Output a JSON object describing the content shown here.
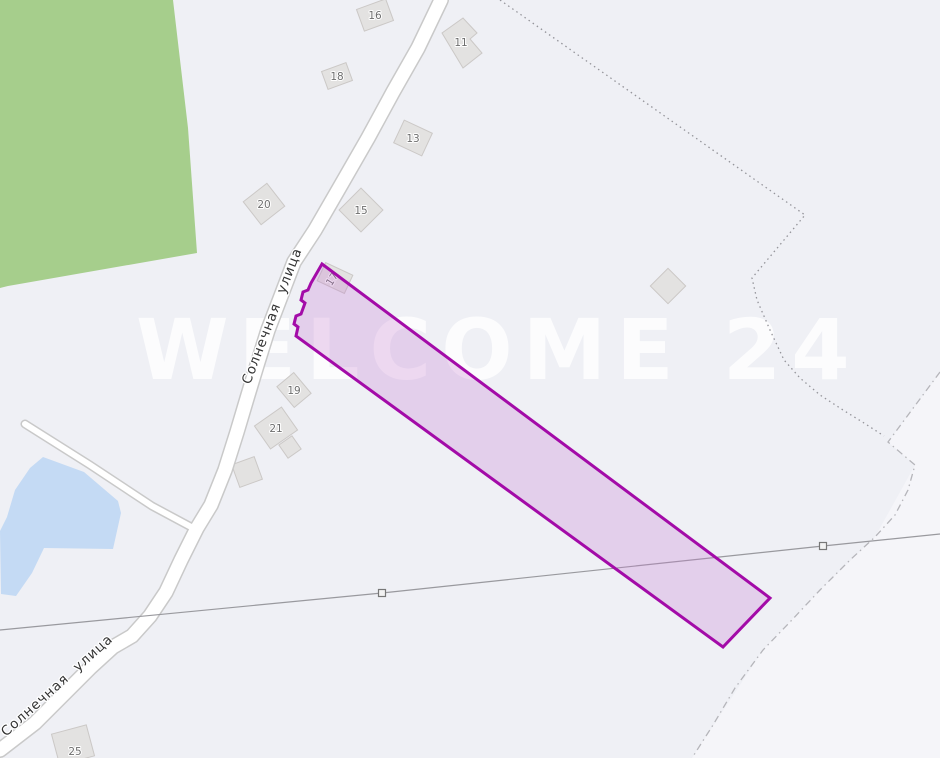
{
  "map": {
    "colors": {
      "background": "#eff0f5",
      "terrain_shade": "#f5f5f9",
      "green_area": "#a6ce8c",
      "pond": "#c4daf4",
      "road_fill": "#ffffff",
      "road_casing": "#c9c9c9",
      "building_fill": "#e3e2e1",
      "building_stroke": "#cbc8c6",
      "power_line": "#99999e",
      "marker_fill": "#f2f2f2",
      "marker_stroke": "#777777",
      "dotted_boundary": "#94949a",
      "dashdot_boundary": "#b5b5ba",
      "parcel_stroke": "#a30ba8",
      "parcel_fill": "rgba(197,122,209,0.28)"
    },
    "terrain_shade": {
      "points": "940,373 888,442 915,465 875,537 820,590 763,650 692,758 940,758"
    },
    "green_area": {
      "points": "0,0 173,0 188,128 197,253 8,286 0,288"
    },
    "pond": {
      "points": "43,457 84,472 118,501 121,513 113,549 44,548 32,573 16,596 1,594 0,531 7,517 15,490 30,468"
    },
    "watermark": {
      "text": "WELCOME 24",
      "x": 136,
      "y": 379
    },
    "buildings": [
      {
        "label": "16",
        "cx": 375,
        "cy": 15,
        "w": 31,
        "h": 23,
        "angle": -20
      },
      {
        "label": "11",
        "points": "442,33 463,18 477,33 470,39 482,53 463,68",
        "lx": 461,
        "ly": 42
      },
      {
        "label": "18",
        "cx": 337,
        "cy": 76,
        "w": 26,
        "h": 19,
        "angle": -20
      },
      {
        "label": "13",
        "cx": 413,
        "cy": 138,
        "w": 31,
        "h": 25,
        "angle": 25
      },
      {
        "label": "20",
        "cx": 264,
        "cy": 204,
        "w": 30,
        "h": 29,
        "angle": -38
      },
      {
        "label": "15",
        "cx": 361,
        "cy": 210,
        "w": 31,
        "h": 31,
        "angle": -45
      },
      {
        "label": "19",
        "cx": 294,
        "cy": 390,
        "w": 22,
        "h": 27,
        "angle": -40
      },
      {
        "label": "21",
        "cx": 276,
        "cy": 428,
        "w": 33,
        "h": 28,
        "angle": -35
      },
      {
        "label": "",
        "cx": 290,
        "cy": 447,
        "w": 16,
        "h": 16,
        "angle": -35
      },
      {
        "label": "",
        "cx": 247,
        "cy": 472,
        "w": 24,
        "h": 24,
        "angle": -20
      },
      {
        "label": "25",
        "cx": 73,
        "cy": 745,
        "w": 36,
        "h": 32,
        "angle": -15,
        "lx": 75,
        "ly": 751
      },
      {
        "label": "",
        "cx": 668,
        "cy": 286,
        "w": 25,
        "h": 25,
        "angle": 45
      }
    ],
    "roads": {
      "main": {
        "points": "441,0 418,48 393,92 368,138 341,185 315,230 294,262 281,296 268,330 258,362 248,395 237,432 225,470 211,505 197,528 181,560 166,592 150,616 132,636 113,647 90,668 63,695 35,723 0,750",
        "width": 13,
        "casing": 16
      },
      "side": {
        "points": "25,424 90,465 152,506 193,528",
        "width": 6,
        "casing": 9
      }
    },
    "street_labels": [
      {
        "text": "Солнечная улица",
        "x": 250,
        "y": 385,
        "angle": -69
      },
      {
        "text": "Солнечная улица",
        "x": 6,
        "y": 737,
        "angle": -42
      }
    ],
    "power_line": {
      "points": "0,630 382,593 823,546 940,534",
      "markers": [
        {
          "x": 382,
          "y": 593
        },
        {
          "x": 823,
          "y": 546
        }
      ]
    },
    "dotted_boundary": {
      "points": "500,0 805,215 752,278 757,300 770,330 784,360 800,378 820,395 843,410 864,423 884,436"
    },
    "dashdot_boundary": {
      "points": "940,372 888,442 915,465 908,490 895,515 875,537 850,560 820,590 790,622 763,650 735,688 713,725 692,758"
    },
    "parcel_building": {
      "label": "17",
      "cx": 335,
      "cy": 278,
      "w": 30,
      "h": 20,
      "angle": 25,
      "label_angle": -57
    },
    "parcel": {
      "points": "322,264 770,598 723,647 296,336 298,327 294,324 296,316 301,314 305,303 301,300 303,292 308,290 311,283"
    }
  }
}
